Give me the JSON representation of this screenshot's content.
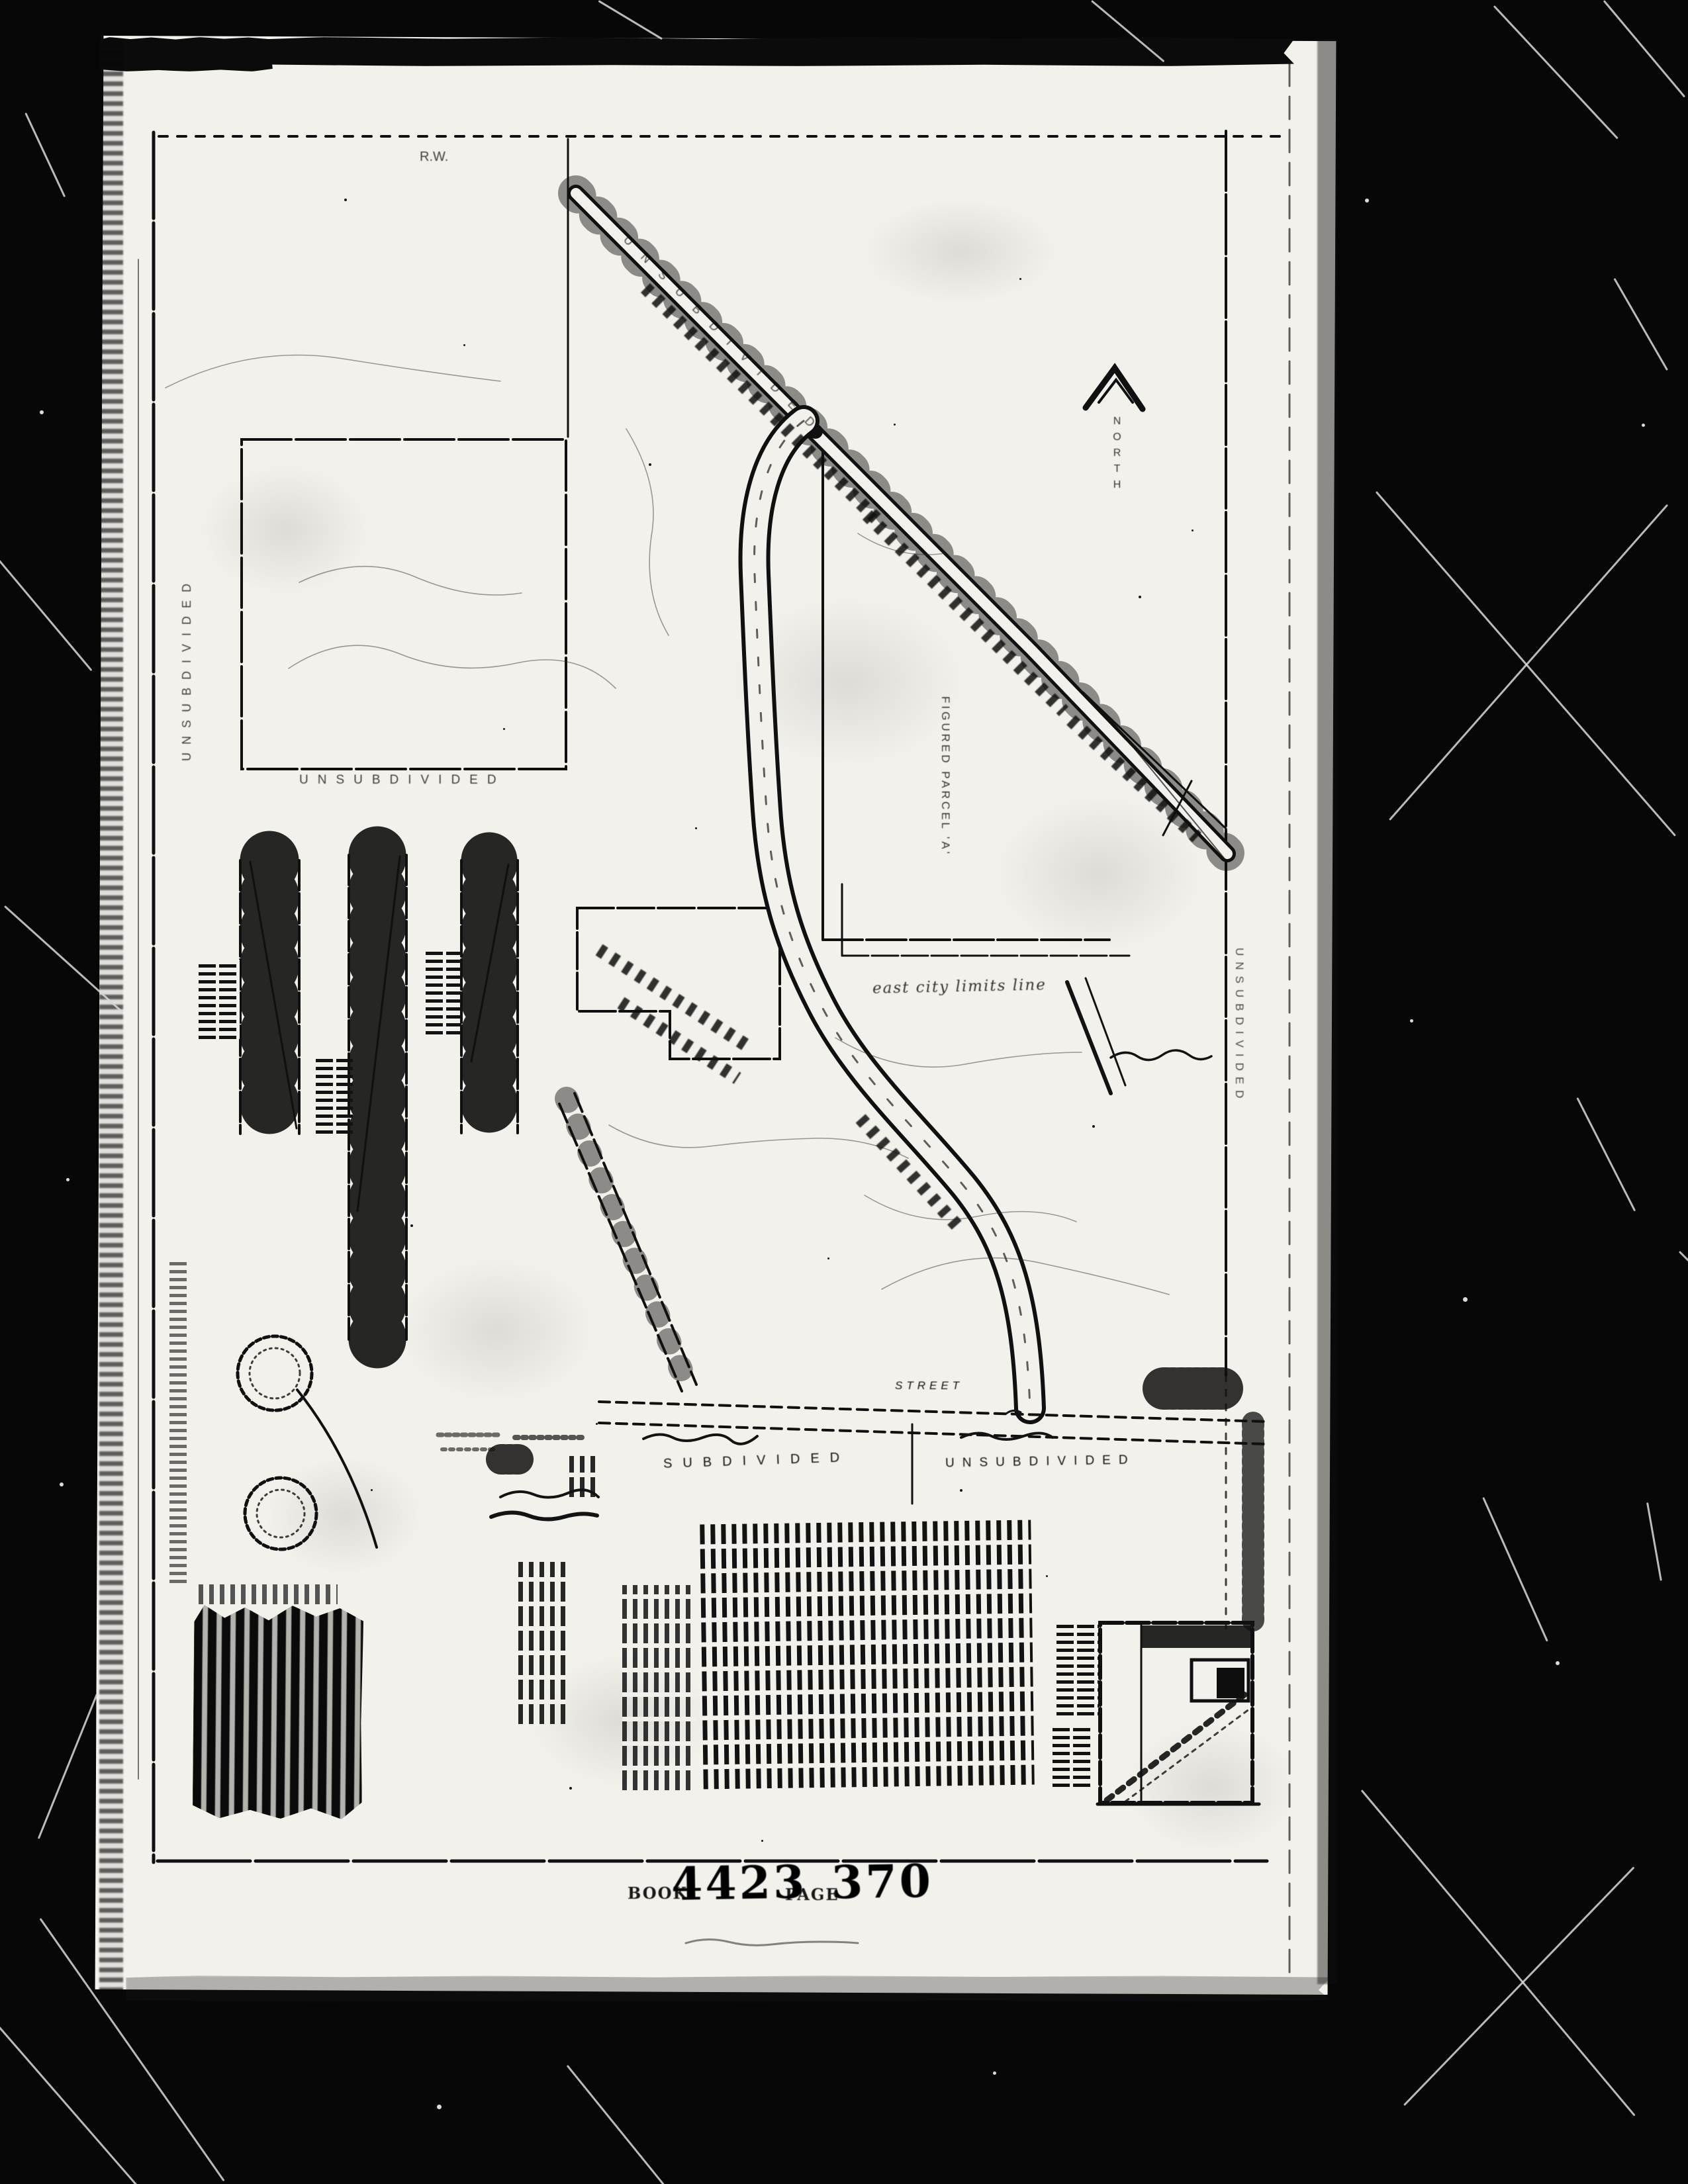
{
  "stamp": {
    "book_label": "BOOK",
    "book_number": "4423",
    "page_label": "PAGE",
    "page_number": "370"
  },
  "map_labels": {
    "left_margin_area": "UNSUBDIVIDED",
    "upper_left_area": "UNSUBDIVIDED",
    "northeast_area": "UNSUBDIVIDED",
    "right_margin_area": "UNSUBDIVIDED",
    "bottom_left_area": "SUBDIVIDED",
    "bottom_right_area": "UNSUBDIVIDED",
    "street": "STREET",
    "parcel_a": "FIGURED PARCEL 'A'",
    "city_limits_line": "east city limits line",
    "north": "NORTH",
    "right_of_way_mark": "R.W."
  },
  "icons": {
    "north_arrow": "north-arrow",
    "notary_seal_upper": "seal-stamp",
    "notary_seal_lower": "seal-stamp"
  },
  "colors": {
    "paper": "#f3f1ec",
    "ink": "#101010",
    "margin_black": "#070707"
  }
}
